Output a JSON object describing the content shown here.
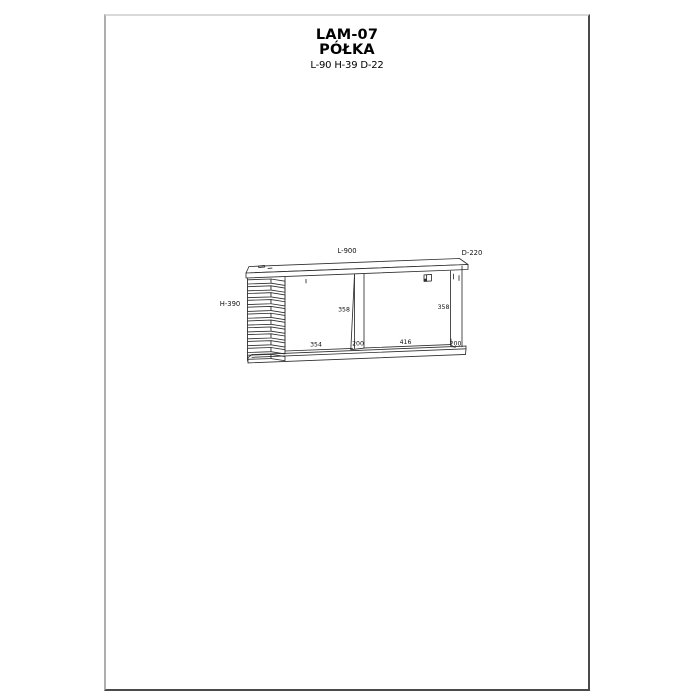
{
  "page": {
    "background": "#ffffff",
    "border_light": "#d9d9d9",
    "border_mid": "#aeaeae",
    "border_dark": "#4a4a4a"
  },
  "header": {
    "model": "LAM-07",
    "product_name": "PÓŁKA",
    "size_summary": "L-90 H-39 D-22"
  },
  "drawing": {
    "line_color": "#2e2e2e",
    "labels": {
      "length": "L-900",
      "depth": "D-220",
      "height": "H-390",
      "left_section_height": "358",
      "right_section_height": "358",
      "left_section_width": "354",
      "divider_depth": "200",
      "right_section_width": "416",
      "side_panel_depth": "200"
    }
  }
}
